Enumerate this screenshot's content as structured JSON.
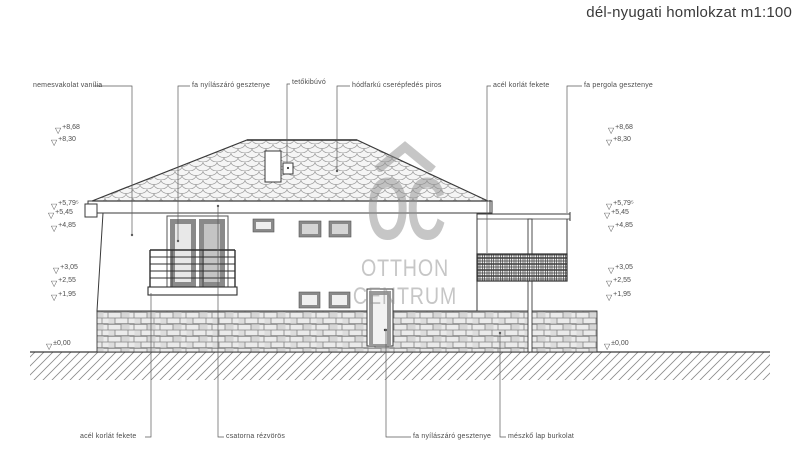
{
  "title": "dél-nyugati homlokzat m1:100",
  "watermark": {
    "logo_text": "OC",
    "name_line1": "OTTHON",
    "name_line2": "CENTRUM"
  },
  "annotations": {
    "top": [
      "nemesvakolat vanília",
      "fa nyílászáró gesztenye",
      "tetőkibúvó",
      "hódfarkú cserépfedés piros",
      "acél korlát fekete",
      "fa pergola gesztenye"
    ],
    "bottom": [
      "acél korlát fekete",
      "csatorna rézvörös",
      "fa nyílászáró gesztenye",
      "mészkő lap burkolat"
    ]
  },
  "elevations": {
    "glyph": "▽",
    "values": [
      "+8,68",
      "+8,30",
      "+5,79⁵",
      "+5,45",
      "+4,85",
      "+3,05",
      "+2,55",
      "+1,95",
      "±0,00"
    ]
  },
  "colors": {
    "line": "#3a3a3a",
    "pattern_gray": "#9a9a9a",
    "watermark_gray": "#8f8f8f",
    "paper": "#ffffff",
    "frame_dark": "#8a8a8a"
  }
}
